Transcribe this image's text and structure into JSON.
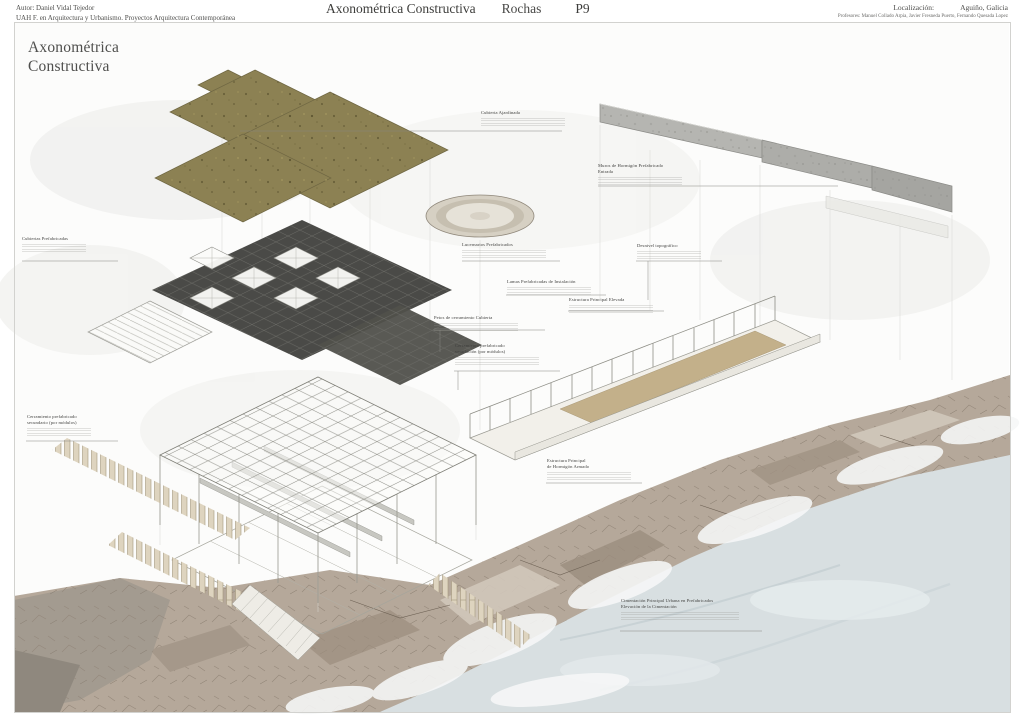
{
  "header": {
    "author_line1": "Autor: Daniel Vidal Tejedor",
    "author_line2": "UAH F. en Arquitectura y Urbanismo. Proyectos Arquitectura Contemporánea",
    "title": "Axonométrica Constructiva",
    "project_name": "Rochas",
    "sheet_number": "P9",
    "location_label": "Localización:",
    "location_value": "Aguiño, Galicia",
    "professors_label": "Profesores:",
    "professors_value": "Manuel Collado Arpia, Javier Fresneda Puerto, Fernando Quesada Lopez"
  },
  "drawing": {
    "title_line1": "Axonométrica",
    "title_line2": "Constructiva",
    "annotations": [
      {
        "id": "cubierta-ajardinada",
        "heading": "Cubierta Ajardinada",
        "heading2": ""
      },
      {
        "id": "muros-hormigon-entrada",
        "heading": "Muros de Hormigón Prefabricado",
        "heading2": "Entrada"
      },
      {
        "id": "cubiertas-prefabricadas",
        "heading": "Cubiertas Prefabricadas",
        "heading2": ""
      },
      {
        "id": "lucernarios-prefabricados",
        "heading": "Lucernarios Prefabricados",
        "heading2": ""
      },
      {
        "id": "lamas-instalacion",
        "heading": "Lamas Prefabricadas de Instalación",
        "heading2": ""
      },
      {
        "id": "desnivel-topografico",
        "heading": "Desnivel topográfico",
        "heading2": ""
      },
      {
        "id": "estructura-elevada",
        "heading": "Estructura Principal Elevada",
        "heading2": ""
      },
      {
        "id": "petos-cubierta",
        "heading": "Petos de cerramiento Cubierta",
        "heading2": ""
      },
      {
        "id": "cerramiento-ventilacion",
        "heading": "Cerramiento prefabricado",
        "heading2": "ventilación (por módulos)"
      },
      {
        "id": "cerramiento-secundario",
        "heading": "Cerramiento prefabricado",
        "heading2": "secundario (por módulos)"
      },
      {
        "id": "estructura-hormigon",
        "heading": "Estructura Principal",
        "heading2": "de Hormigón Armado"
      },
      {
        "id": "cimentacion-urbana",
        "heading": "Cimentación Principal Urbana en Prefabricados",
        "heading2": "Elevación de la Cimentación"
      }
    ]
  },
  "colors": {
    "green_roof": "#8c8153",
    "dark_slab": "#4a4a47",
    "concrete_wall": "#b3b3af",
    "rock": "#b5a89a",
    "water": "#d8dfe1",
    "sand_floor": "#c3b08a",
    "piles": "#ded4bf",
    "leader_line": "#878782"
  }
}
